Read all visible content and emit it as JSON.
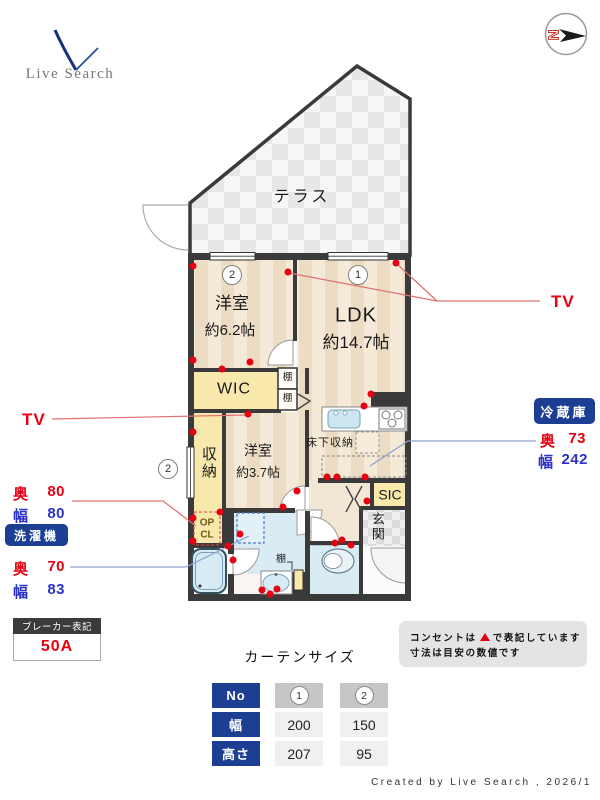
{
  "logo": {
    "brand": "Live Search"
  },
  "compass": {
    "north": "N"
  },
  "plan": {
    "terrace_label": "テラス",
    "room_west_large": {
      "no": "2",
      "name": "洋室",
      "size": "約6.2帖"
    },
    "ldk": {
      "no": "1",
      "name": "LDK",
      "size": "約14.7帖"
    },
    "wic_label": "WIC",
    "shelf_label_1": "棚",
    "shelf_label_2": "棚",
    "shelf_label_3": "棚",
    "closet_label": "収納",
    "open_closet_line1": "OP",
    "open_closet_line2": "CL",
    "room_west_small": {
      "name": "洋室",
      "size": "約3.7帖"
    },
    "underfloor_label": "床下収納",
    "sic_label": "SIC",
    "entrance_label": "玄関",
    "window_marker_no": "2"
  },
  "callouts": {
    "tv_right": "TV",
    "tv_left": "TV",
    "fridge_title": "冷蔵庫",
    "fridge_depth_k": "奥",
    "fridge_depth_v": "73",
    "fridge_width_k": "幅",
    "fridge_width_v": "242",
    "closet_depth_k": "奥",
    "closet_depth_v": "80",
    "closet_width_k": "幅",
    "closet_width_v": "80",
    "washer_title": "洗濯機",
    "washer_depth_k": "奥",
    "washer_depth_v": "70",
    "washer_width_k": "幅",
    "washer_width_v": "83"
  },
  "breaker": {
    "title": "ブレーカー表記",
    "value": "50A"
  },
  "note": {
    "line1_pre": "コンセントは",
    "line1_post": "で表記しています",
    "line2": "寸法は目安の数値です"
  },
  "curtain": {
    "title": "カーテンサイズ",
    "no_label": "No",
    "width_label": "幅",
    "height_label": "高さ",
    "col1": "1",
    "col2": "2",
    "width1": "200",
    "width2": "150",
    "height1": "207",
    "height2": "95"
  },
  "footer": {
    "credit": "Created by Live Search , 2026/1"
  },
  "outlets": [
    [
      193,
      266
    ],
    [
      288,
      272
    ],
    [
      396,
      263
    ],
    [
      193,
      360
    ],
    [
      250,
      362
    ],
    [
      222,
      369
    ],
    [
      248,
      414
    ],
    [
      193,
      432
    ],
    [
      364,
      406
    ],
    [
      371,
      394
    ],
    [
      297,
      491
    ],
    [
      327,
      477
    ],
    [
      337,
      477
    ],
    [
      365,
      477
    ],
    [
      220,
      512
    ],
    [
      193,
      518
    ],
    [
      240,
      534
    ],
    [
      283,
      507
    ],
    [
      233,
      560
    ],
    [
      193,
      541
    ],
    [
      228,
      546
    ],
    [
      335,
      543
    ],
    [
      351,
      545
    ],
    [
      367,
      501
    ],
    [
      342,
      540
    ],
    [
      262,
      590
    ],
    [
      270,
      594
    ],
    [
      277,
      589
    ]
  ],
  "colors": {
    "accent_navy": "#1c3f94",
    "red": "#e60012",
    "blue": "#2b32c8",
    "wall": "#3a3a3a"
  }
}
